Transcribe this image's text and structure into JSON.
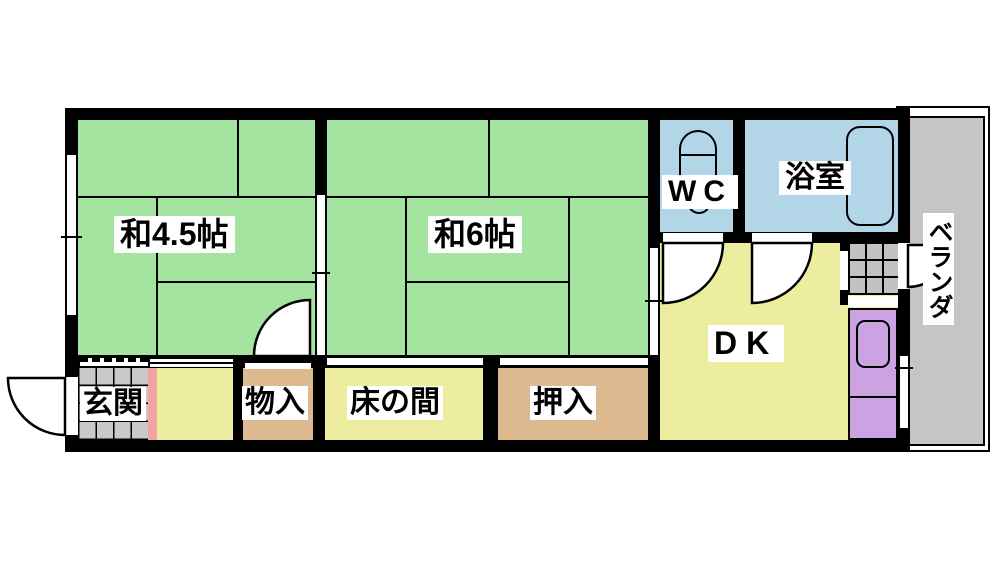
{
  "plan": {
    "type": "japanese-apartment-floor-plan",
    "rooms": {
      "japanese_room_45": {
        "label": "和4.5帖",
        "color": "#a5e3a0"
      },
      "japanese_room_6": {
        "label": "和6帖",
        "color": "#a5e3a0"
      },
      "wc": {
        "label": "WC",
        "color": "#b2d5e8"
      },
      "bath": {
        "label": "浴室",
        "color": "#b2d5e8"
      },
      "dk": {
        "label": "DK",
        "color": "#ededa0"
      },
      "veranda": {
        "label": "ベランダ",
        "color": "#c5c5c5"
      },
      "genkan": {
        "label": "玄関",
        "color": "#c9c9c9"
      },
      "storage": {
        "label": "物入",
        "color": "#ddb990"
      },
      "tokonoma": {
        "label": "床の間",
        "color": "#ededa0"
      },
      "closet": {
        "label": "押入",
        "color": "#ddb990"
      },
      "hall": {
        "color": "#ededa0"
      }
    },
    "accents": {
      "wall": "#000000",
      "entrance_step_pink": "#f2a3a3",
      "kitchen_unit_purple": "#cda2e2",
      "kitchen_tile_gray": "#c2c2c2",
      "veranda_gray": "#c5c5c5"
    },
    "fixtures": [
      "toilet",
      "bathtub",
      "kitchen-sink",
      "tiled-kitchen-floor",
      "entrance-tile-floor"
    ]
  }
}
